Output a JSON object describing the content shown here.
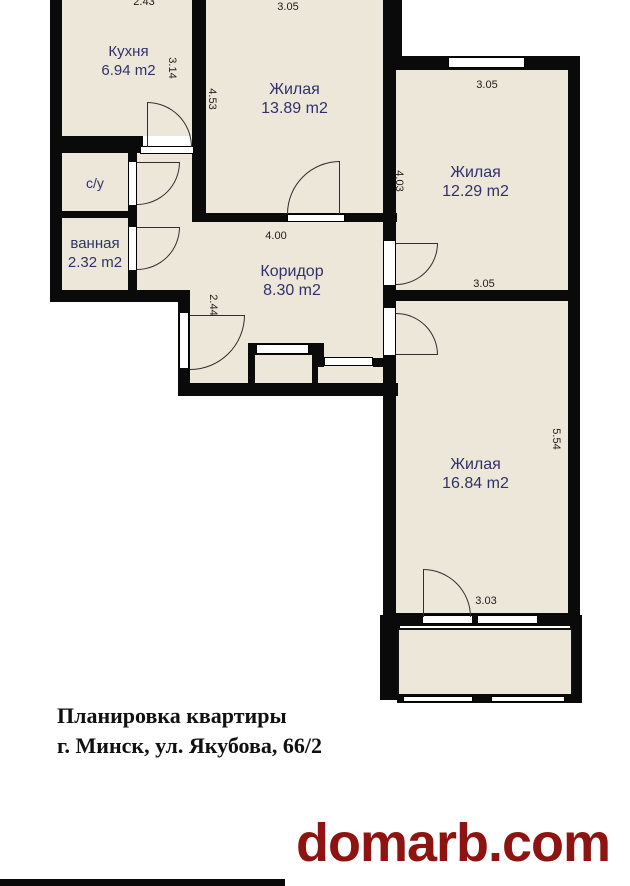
{
  "plan": {
    "rooms": [
      {
        "name": "Кухня",
        "area": "6.94 m2"
      },
      {
        "name": "Жилая",
        "area": "13.89 m2"
      },
      {
        "name": "Жилая",
        "area": "12.29 m2"
      },
      {
        "name": "с/у",
        "area": ""
      },
      {
        "name": "ванная",
        "area": "2.32 m2"
      },
      {
        "name": "Коридор",
        "area": "8.30 m2"
      },
      {
        "name": "Жилая",
        "area": "16.84 m2"
      }
    ],
    "dimensions": {
      "kitchen_top": "2.43",
      "living1_top": "3.05",
      "kitchen_right": "3.14",
      "living1_left": "4.53",
      "living2_top": "3.05",
      "living2_left": "4.03",
      "corridor_top": "4.00",
      "living2_bottom": "3.05",
      "corridor_left": "2.44",
      "living3_right": "5.54",
      "living3_bottom": "3.03"
    }
  },
  "caption": {
    "line1": "Планировка квартиры",
    "line2": "г. Минск, ул. Якубова, 66/2"
  },
  "brand": {
    "text": "domarb.com"
  },
  "colors": {
    "wall": "#0a0a0a",
    "floor": "#ece7d8",
    "room_label": "#31316e",
    "brand_red": "#8d1410"
  }
}
